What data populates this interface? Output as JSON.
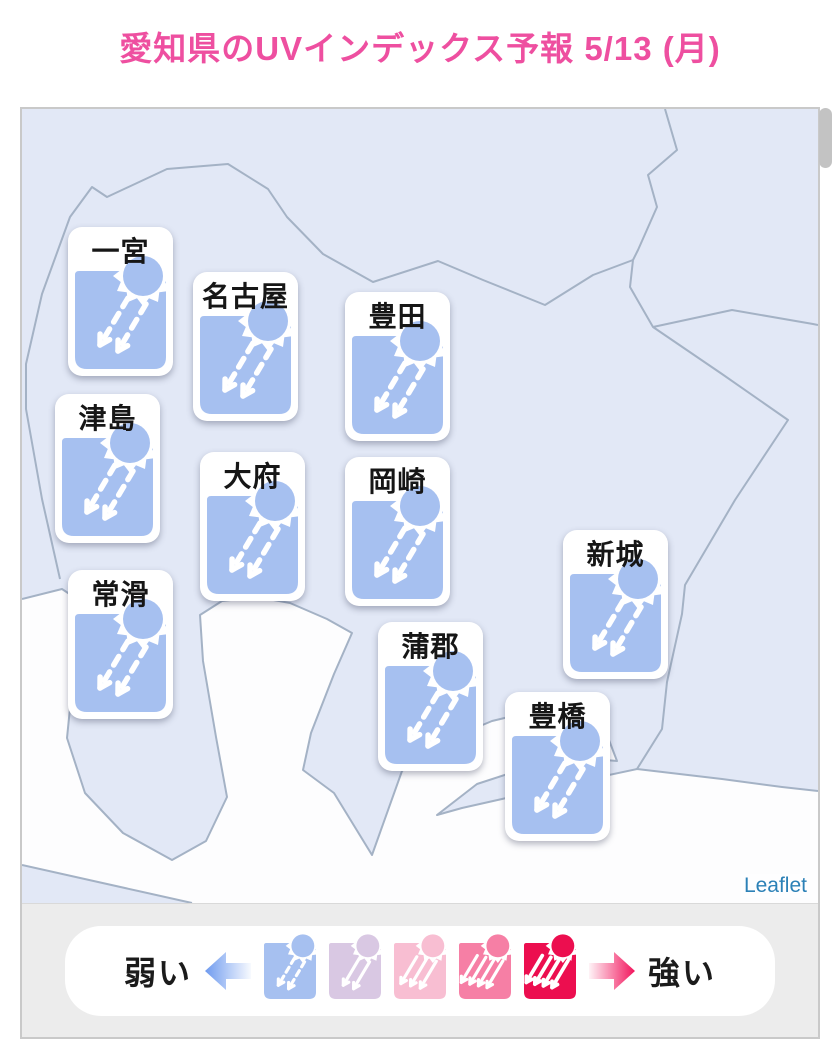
{
  "title": "愛知県のUVインデックス予報 5/13 (月)",
  "title_color": "#ee4fa0",
  "map": {
    "attribution": "Leaflet",
    "colors": {
      "land": "#e2e8f6",
      "sea": "#fdfdfe",
      "border": "#a4b2c5",
      "attribution_blue": "#2c81b7"
    },
    "cities": [
      {
        "name": "一宮",
        "level": 1
      },
      {
        "name": "名古屋",
        "level": 1
      },
      {
        "name": "豊田",
        "level": 1
      },
      {
        "name": "津島",
        "level": 1
      },
      {
        "name": "大府",
        "level": 1
      },
      {
        "name": "岡崎",
        "level": 1
      },
      {
        "name": "新城",
        "level": 1
      },
      {
        "name": "常滑",
        "level": 1
      },
      {
        "name": "蒲郡",
        "level": 1
      },
      {
        "name": "豊橋",
        "level": 1
      }
    ]
  },
  "legend": {
    "weak_label": "弱い",
    "strong_label": "強い",
    "weak_arrow_color": "#6f9bef",
    "strong_arrow_color": "#f2145c",
    "levels": [
      {
        "name": "uv-level-1",
        "color": "#a6c0f0",
        "arrows": 2,
        "dashed": true
      },
      {
        "name": "uv-level-2",
        "color": "#d9c8e3",
        "arrows": 2,
        "dashed": false
      },
      {
        "name": "uv-level-3",
        "color": "#f8bed2",
        "arrows": 3,
        "dashed": false
      },
      {
        "name": "uv-level-4",
        "color": "#f67fa5",
        "arrows": 4,
        "dashed": false
      },
      {
        "name": "uv-level-5",
        "color": "#ec0e4f",
        "arrows": 4,
        "dashed": false
      }
    ]
  }
}
